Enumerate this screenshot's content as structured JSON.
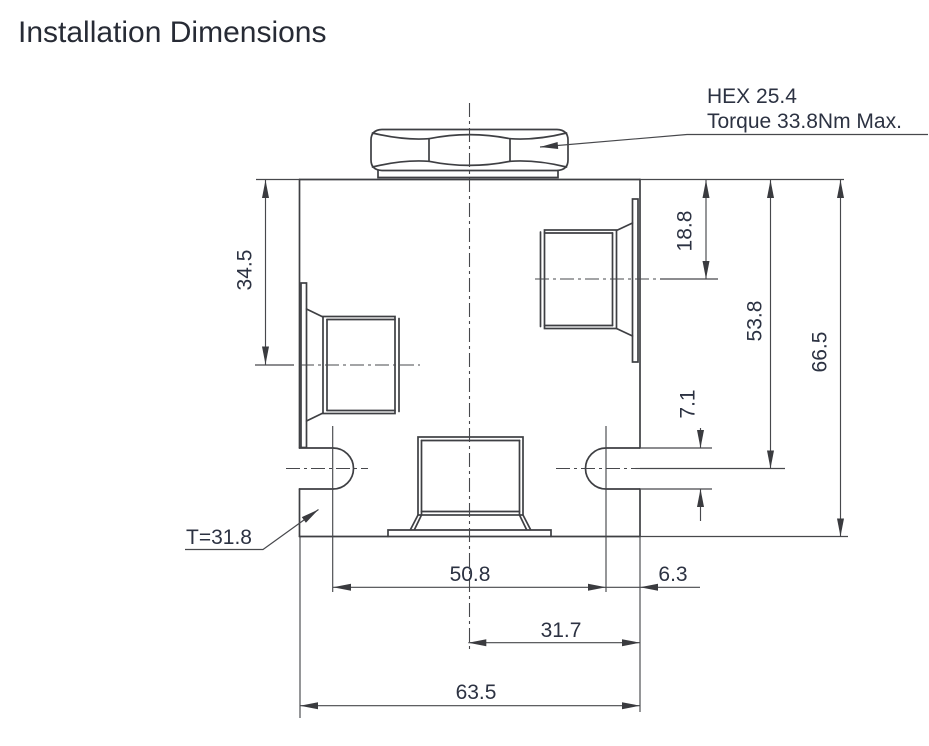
{
  "title": "Installation Dimensions",
  "callouts": {
    "hex": "HEX 25.4",
    "torque": "Torque 33.8Nm Max.",
    "thickness": "T=31.8"
  },
  "dimensions": {
    "left_port_center": "34.5",
    "right_port_center": "18.8",
    "slot_center_from_top": "53.8",
    "overall_height": "66.5",
    "slot_width": "7.1",
    "slot_center_spacing": "50.8",
    "slot_center_to_edge": "6.3",
    "center_to_right_edge": "31.7",
    "overall_width": "63.5"
  },
  "colors": {
    "line": "#3e3f43",
    "text": "#2c3242",
    "background": "#ffffff"
  }
}
